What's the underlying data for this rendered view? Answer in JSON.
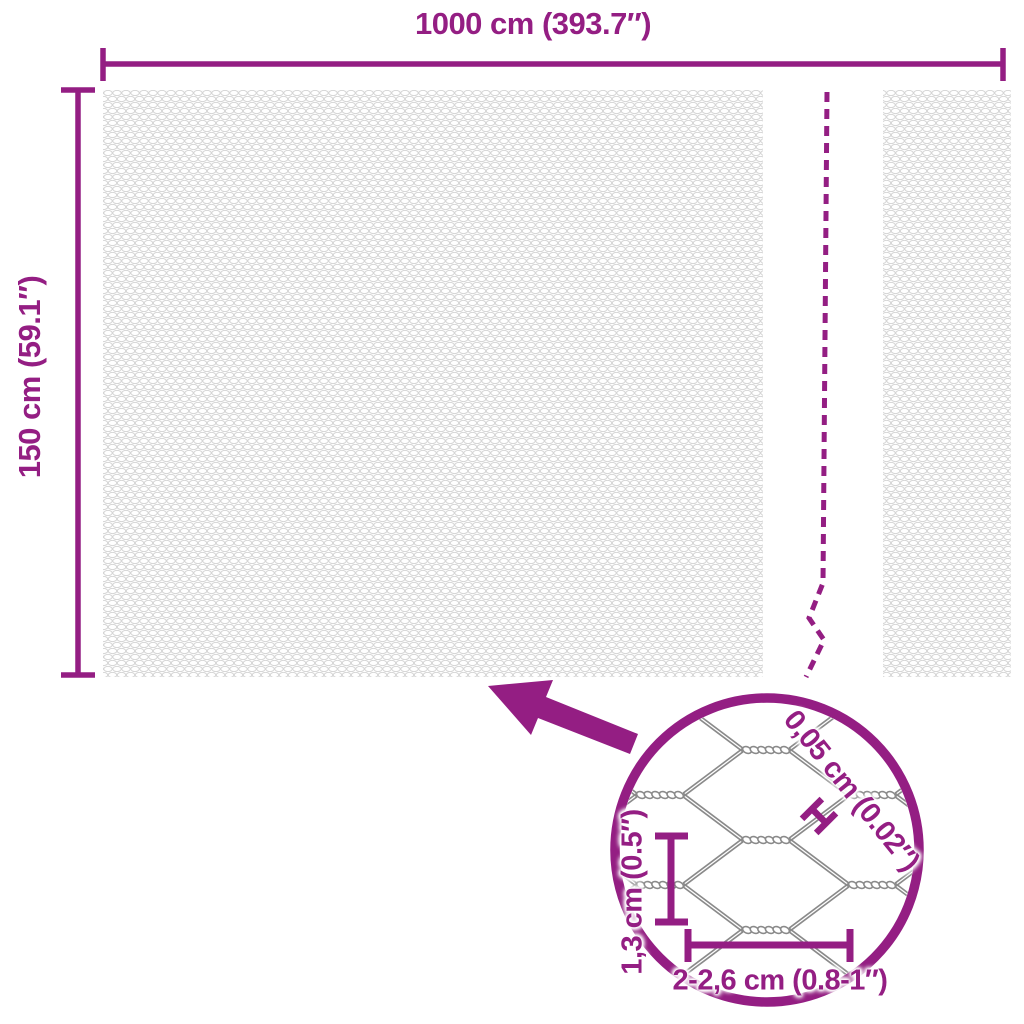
{
  "colors": {
    "accent": "#941E83",
    "wire_gray": "#8a8a8a",
    "mesh_texture_gray": "#d5d5d5"
  },
  "main_dimensions": {
    "width": "1000 cm (393.7″)",
    "height": "150 cm (59.1″)"
  },
  "detail_circle": {
    "wire_thickness": "0,05 cm (0.02″)",
    "mesh_opening_height": "1,3 cm (0.5″)",
    "mesh_opening_width": "2-2,6 cm (0.8-1″)"
  }
}
